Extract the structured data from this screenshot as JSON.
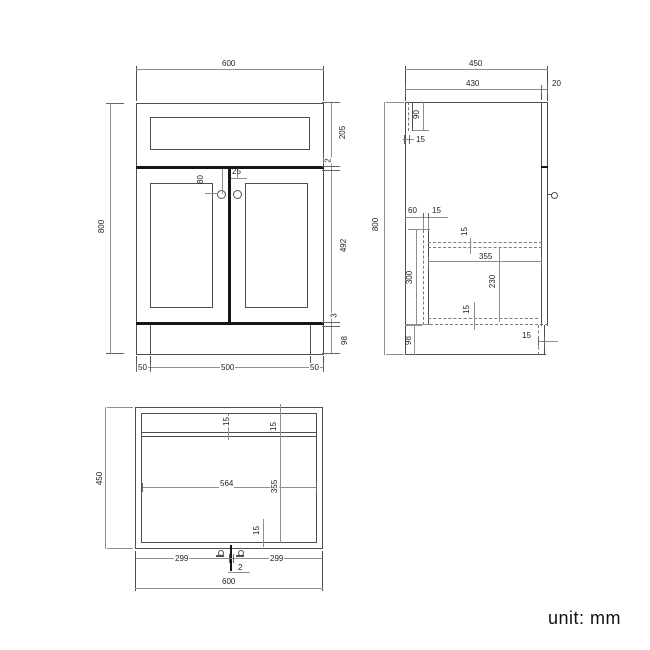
{
  "unit_label": "unit: mm",
  "front_view": {
    "width": "600",
    "height": "800",
    "drawer_front_height": "205",
    "worktop_gap": "2",
    "door_height": "492",
    "door_bottom_gap": "3",
    "plinth_height": "98",
    "plinth_inset_left": "50",
    "plinth_width": "500",
    "plinth_inset_right": "50",
    "handle_drop": "80",
    "handle_offset": "25"
  },
  "side_view": {
    "depth": "450",
    "body_depth": "430",
    "door_thickness": "20",
    "back_rail_height": "90",
    "back_rail_thickness": "15",
    "height": "800",
    "back_offset": "60",
    "support_thickness": "15",
    "support_height": "300",
    "shelf_thickness": "15",
    "shelf_depth": "355",
    "shelf_clearance": "230",
    "bottom_panel_thickness": "15",
    "plinth_height": "98",
    "plinth_recess": "15"
  },
  "top_view": {
    "depth": "450",
    "back_rail_thickness": "15",
    "back_rail_inset": "15",
    "internal_width": "564",
    "internal_depth": "355",
    "front_panel_thickness": "15",
    "door_width_left": "299",
    "door_gap": "2",
    "door_width_right": "299",
    "width": "600"
  }
}
